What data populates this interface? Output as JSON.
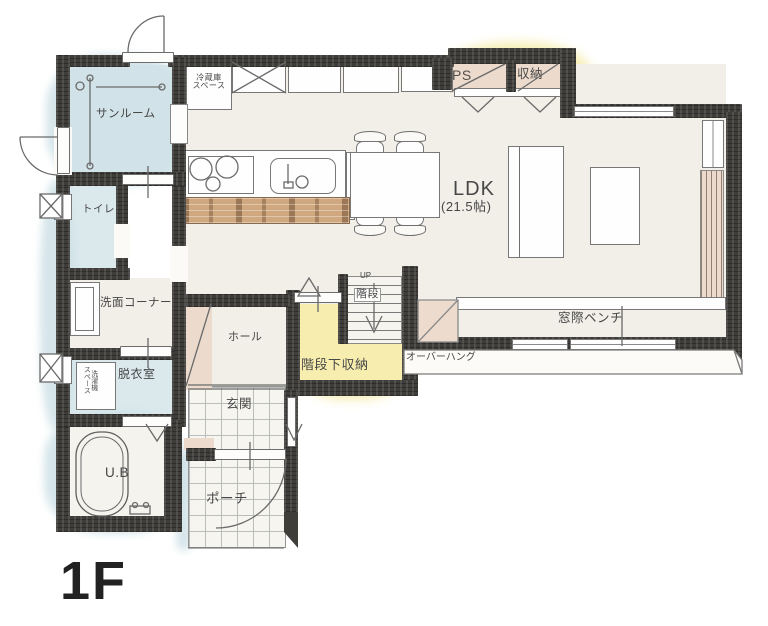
{
  "labels": {
    "floor": "1F",
    "sunroom": "サンルーム",
    "fridge": "冷蔵庫\nスペース",
    "ps": "PS",
    "storage": "収納",
    "ldk_name": "LDK",
    "ldk_size": "(21.5帖)",
    "toilet": "トイレ",
    "washroom": "洗面コーナー",
    "dressing": "脱衣室",
    "laundry": "洗濯機\nスペース",
    "bath": "U.B",
    "hall": "ホール",
    "entrance": "玄関",
    "porch": "ポーチ",
    "stairs": "階段",
    "stairs_up": "UP",
    "under_stairs": "階段下収納",
    "bench": "窓際ベンチ",
    "overhang": "オーバーハング"
  },
  "colors": {
    "wall": "#3f3d3a",
    "floor": "#f1efe8",
    "water_blue": "#cfe1e7",
    "highlight_yellow": "#f6edae",
    "closet_pink": "#ecdacc",
    "wood": "#cfa87f"
  }
}
